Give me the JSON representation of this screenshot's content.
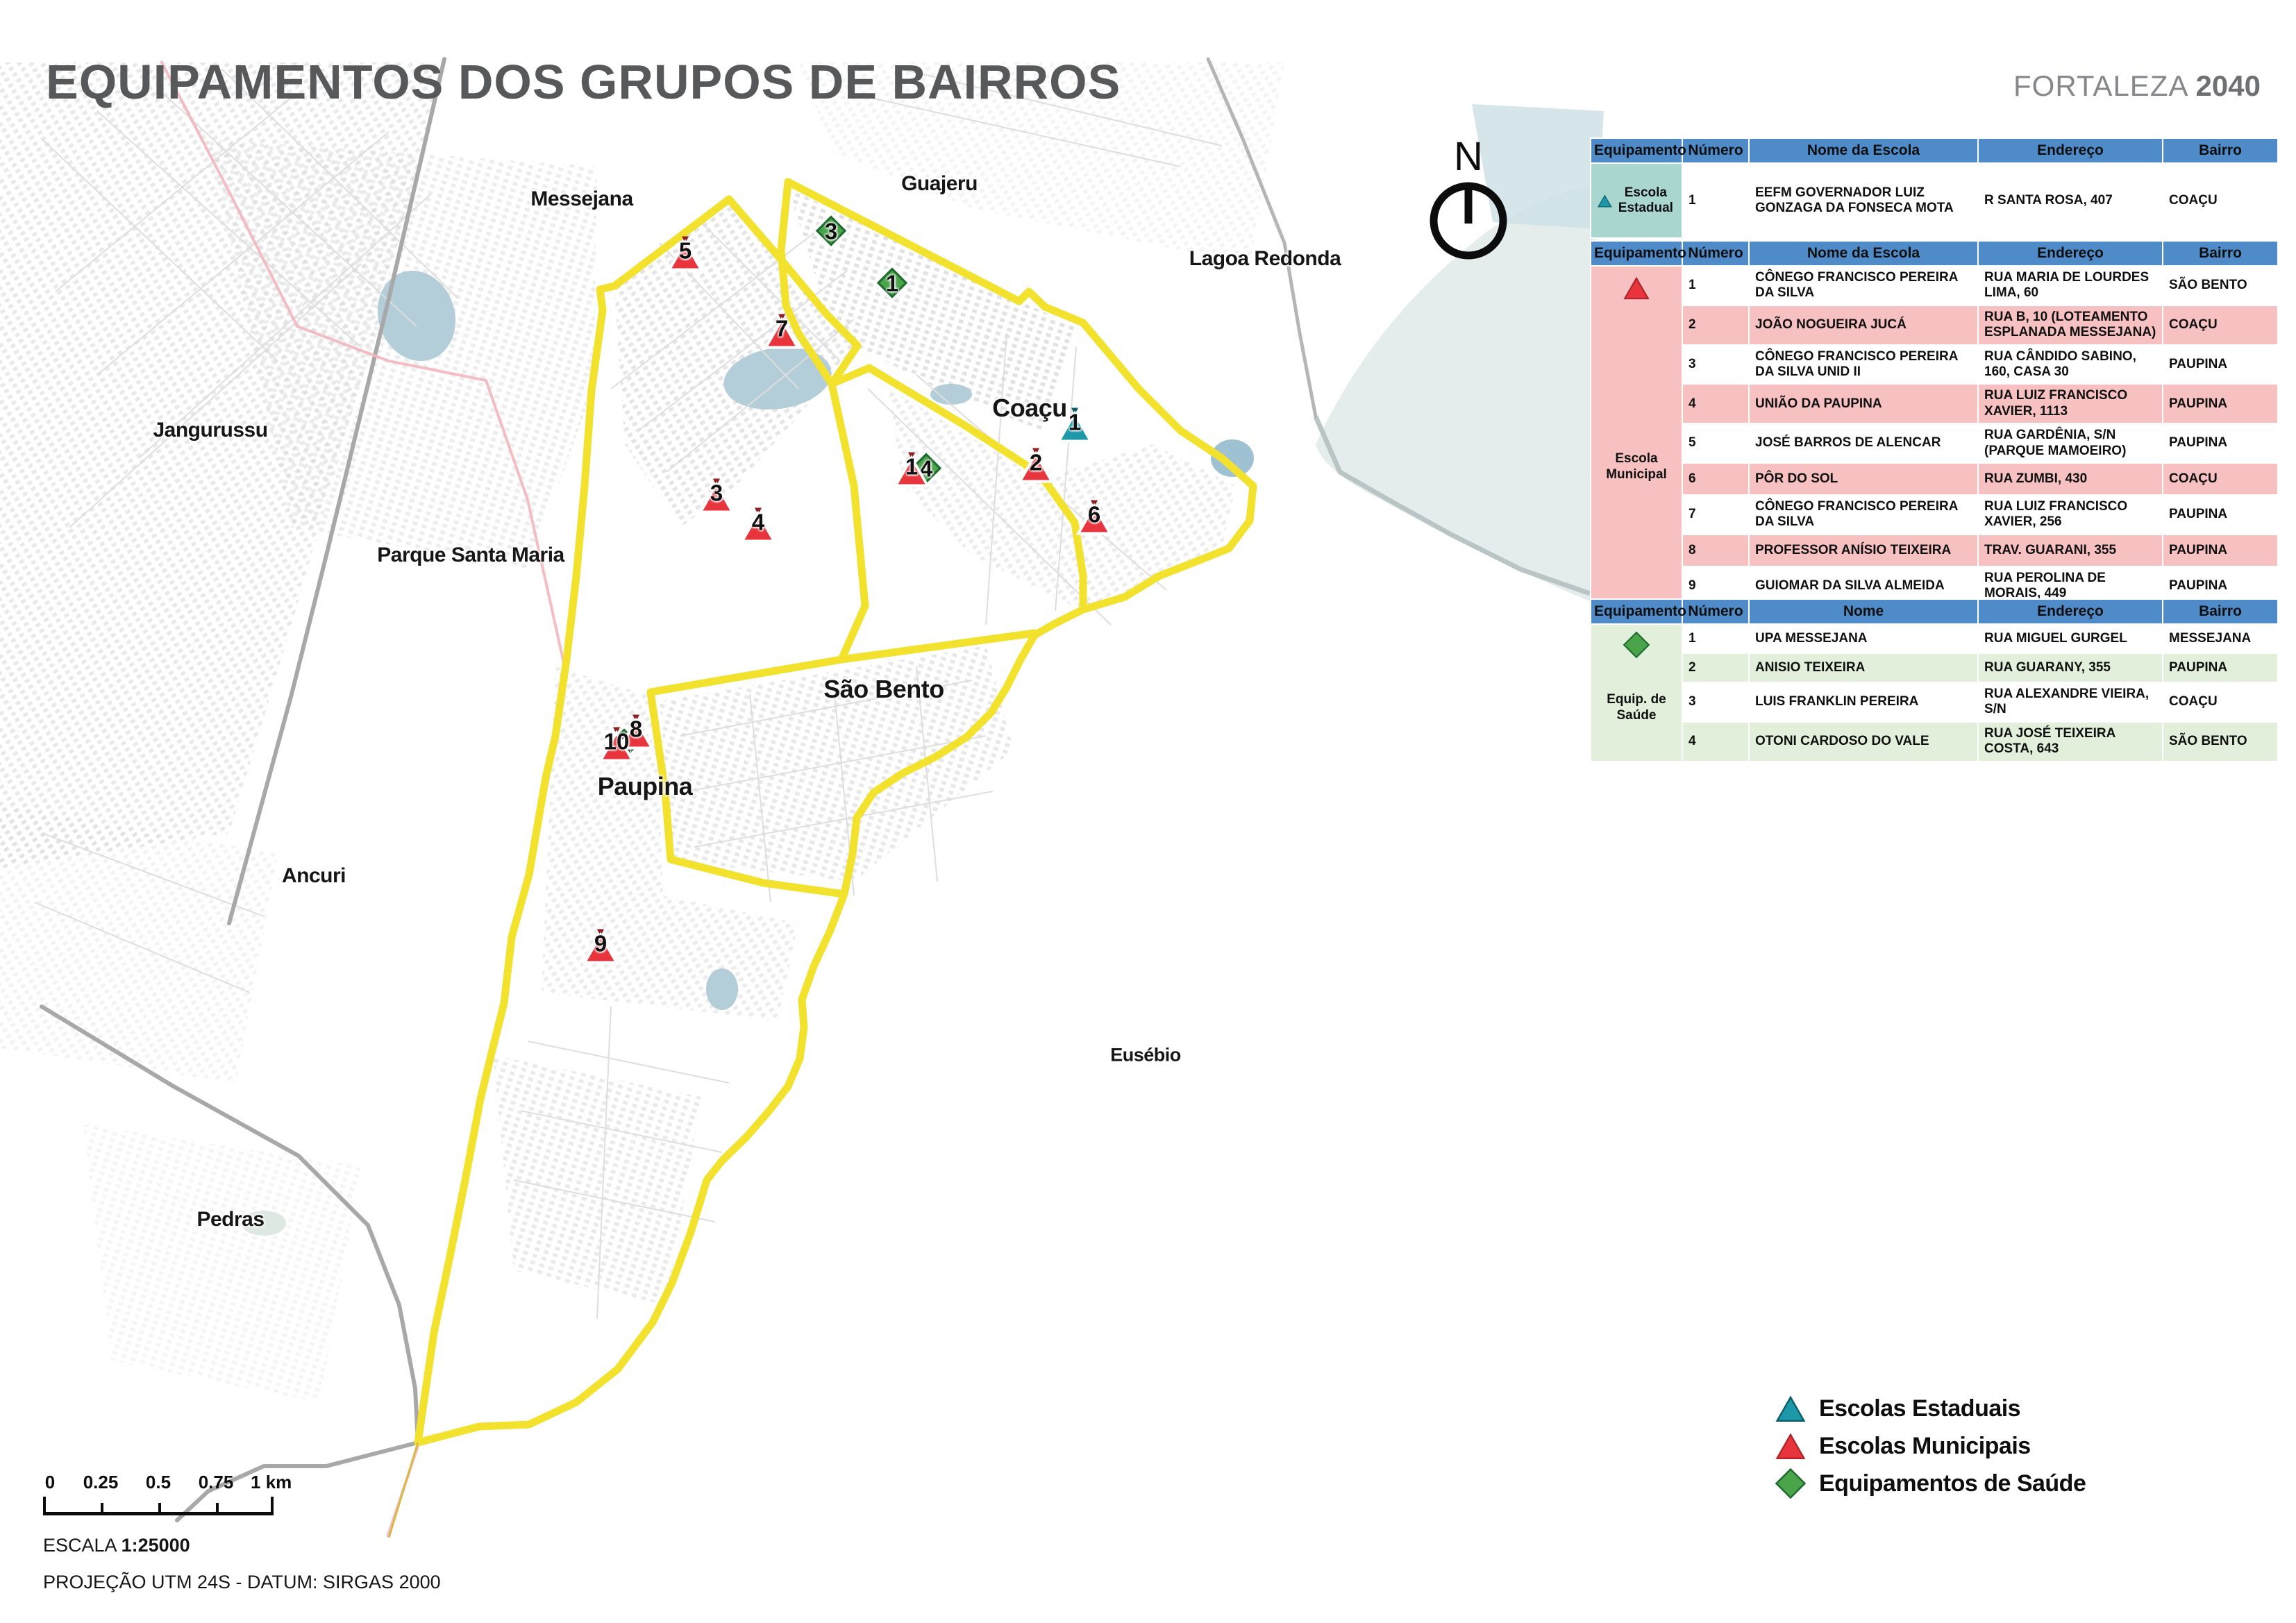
{
  "title": "EQUIPAMENTOS DOS GRUPOS DE BAIRROS",
  "brand": {
    "name": "FORTALEZA",
    "year": "2040"
  },
  "north_label": "N",
  "map": {
    "region_labels": [
      {
        "id": "messejana",
        "text": "Messejana"
      },
      {
        "id": "guajeru",
        "text": "Guajeru"
      },
      {
        "id": "lagoa-redonda",
        "text": "Lagoa Redonda"
      },
      {
        "id": "jangurussu",
        "text": "Jangurussu"
      },
      {
        "id": "parque-santa-maria",
        "text": "Parque Santa Maria"
      },
      {
        "id": "ancuri",
        "text": "Ancuri"
      },
      {
        "id": "eusebio",
        "text": "Eusébio"
      },
      {
        "id": "pedras",
        "text": "Pedras"
      }
    ],
    "group_labels": [
      {
        "id": "coacu",
        "text": "Coaçu"
      },
      {
        "id": "sao-bento",
        "text": "São Bento"
      },
      {
        "id": "paupina",
        "text": "Paupina"
      }
    ],
    "markers": {
      "estadual": [
        {
          "n": "1"
        }
      ],
      "municipal": [
        {
          "n": "1"
        },
        {
          "n": "2"
        },
        {
          "n": "3"
        },
        {
          "n": "4"
        },
        {
          "n": "5"
        },
        {
          "n": "6"
        },
        {
          "n": "7"
        },
        {
          "n": "8"
        },
        {
          "n": "9"
        },
        {
          "n": "10"
        }
      ],
      "saude": [
        {
          "n": "1"
        },
        {
          "n": "2"
        },
        {
          "n": "3"
        },
        {
          "n": "4"
        }
      ]
    }
  },
  "tables": {
    "estadual": {
      "category": "Escola Estadual",
      "headers": [
        "Equipamento",
        "Número",
        "Nome da Escola",
        "Endereço",
        "Bairro"
      ],
      "rows": [
        {
          "numero": "1",
          "nome": "EEFM GOVERNADOR LUIZ GONZAGA DA FONSECA MOTA",
          "endereco": "R SANTA ROSA, 407",
          "bairro": "COAÇU"
        }
      ]
    },
    "municipal": {
      "category": "Escola Municipal",
      "headers": [
        "Equipamento",
        "Número",
        "Nome da Escola",
        "Endereço",
        "Bairro"
      ],
      "rows": [
        {
          "numero": "1",
          "nome": "CÔNEGO FRANCISCO PEREIRA DA SILVA",
          "endereco": "RUA MARIA DE LOURDES LIMA, 60",
          "bairro": "SÃO BENTO"
        },
        {
          "numero": "2",
          "nome": "JOÃO NOGUEIRA JUCÁ",
          "endereco": "RUA B, 10 (LOTEAMENTO ESPLANADA MESSEJANA)",
          "bairro": "COAÇU"
        },
        {
          "numero": "3",
          "nome": "CÔNEGO FRANCISCO PEREIRA DA SILVA UNID II",
          "endereco": "RUA CÂNDIDO SABINO, 160, CASA 30",
          "bairro": "PAUPINA"
        },
        {
          "numero": "4",
          "nome": "UNIÃO DA PAUPINA",
          "endereco": "RUA LUIZ FRANCISCO XAVIER, 1113",
          "bairro": "PAUPINA"
        },
        {
          "numero": "5",
          "nome": "JOSÉ BARROS DE ALENCAR",
          "endereco": "RUA GARDÊNIA, S/N (PARQUE MAMOEIRO)",
          "bairro": "PAUPINA"
        },
        {
          "numero": "6",
          "nome": "PÔR DO SOL",
          "endereco": "RUA ZUMBI, 430",
          "bairro": "COAÇU"
        },
        {
          "numero": "7",
          "nome": "CÔNEGO FRANCISCO PEREIRA DA SILVA",
          "endereco": "RUA LUIZ FRANCISCO XAVIER, 256",
          "bairro": "PAUPINA"
        },
        {
          "numero": "8",
          "nome": "PROFESSOR ANÍSIO TEIXEIRA",
          "endereco": "TRAV. GUARANI, 355",
          "bairro": "PAUPINA"
        },
        {
          "numero": "9",
          "nome": "GUIOMAR DA SILVA ALMEIDA",
          "endereco": "RUA PEROLINA DE MORAIS, 449",
          "bairro": "PAUPINA"
        },
        {
          "numero": "10",
          "nome": "PROFESSOR ANÍSIO TEIXEIRA",
          "endereco": "TRAV. GUARANI, 355",
          "bairro": "PAUPINA"
        }
      ]
    },
    "saude": {
      "category": "Equip. de Saúde",
      "headers": [
        "Equipamento",
        "Número",
        "Nome",
        "Endereço",
        "Bairro"
      ],
      "rows": [
        {
          "numero": "1",
          "nome": "UPA MESSEJANA",
          "endereco": "RUA MIGUEL GURGEL",
          "bairro": "MESSEJANA"
        },
        {
          "numero": "2",
          "nome": "ANISIO TEIXEIRA",
          "endereco": "RUA GUARANY, 355",
          "bairro": "PAUPINA"
        },
        {
          "numero": "3",
          "nome": "LUIS FRANKLIN PEREIRA",
          "endereco": "RUA ALEXANDRE VIEIRA, S/N",
          "bairro": "COAÇU"
        },
        {
          "numero": "4",
          "nome": "OTONI CARDOSO DO VALE",
          "endereco": "RUA JOSÉ TEIXEIRA COSTA, 643",
          "bairro": "SÃO BENTO"
        }
      ]
    }
  },
  "legend": {
    "items": [
      {
        "id": "estaduais",
        "label": "Escolas Estaduais"
      },
      {
        "id": "municipais",
        "label": "Escolas Municipais"
      },
      {
        "id": "saude",
        "label": "Equipamentos de Saúde"
      }
    ]
  },
  "scalebar": {
    "tick_labels": [
      "0",
      "0.25",
      "0.5",
      "0.75",
      "1 km"
    ],
    "scale_label": "ESCALA",
    "scale_value": "1:25000",
    "projection": "PROJEÇÃO UTM 24S - DATUM: SIRGAS 2000"
  },
  "colors": {
    "header_blue": "#4e8bc8",
    "estadual_teal": "#1d98a8",
    "municipal_red": "#e8353d",
    "saude_green": "#4aa44a",
    "boundary_yellow": "#f2e22e",
    "estadual_bg": "#a9d6cf",
    "municipal_bg": "#f7c1c1",
    "saude_bg": "#e2efda",
    "water_blue": "#b3cdd9"
  }
}
